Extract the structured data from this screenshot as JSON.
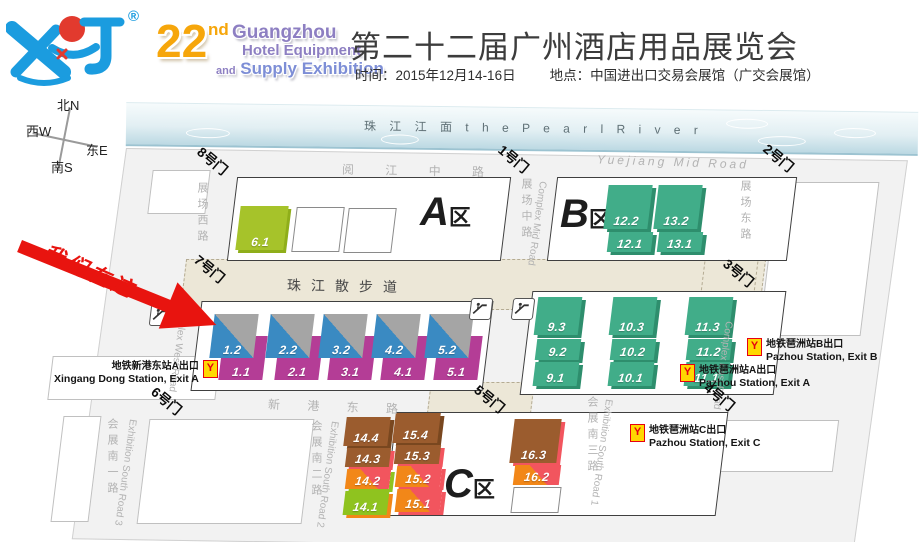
{
  "header": {
    "registered_mark": "®",
    "edition_22": "22",
    "edition_nd": "nd",
    "edition_name1": "Guangzhou",
    "edition_name2": "Hotel Equipment",
    "edition_and": "and",
    "edition_name3": "Supply Exhibition",
    "title": "第二十二届广州酒店用品展览会",
    "info_time": "时间：2015年12月14-16日",
    "info_place": "地点：中国进出口交易会展馆（广交会展馆）"
  },
  "compass": {
    "north": "北N",
    "west": "西W",
    "east": "东E",
    "south": "南S"
  },
  "map": {
    "river_label": "珠  江  江  面      t h e    P e a r l    R i v e r",
    "promenade_label": "珠江散步道",
    "roads": {
      "yuejiang_cn": "阅  江  中  路",
      "yuejiang_en": "Yuejiang  Mid  Road",
      "xingang_cn": "新  港  东  路",
      "complex_west_cn": "展场西路",
      "complex_west_en": "Complex West Road",
      "complex_mid_cn": "展场中路",
      "complex_mid_en": "Complex Mid Road",
      "complex_east_cn": "展场东路",
      "complex_east_en": "Complex East Road",
      "south1_cn": "会展南一路",
      "south1_en": "Exhibition South Road 3",
      "south2_cn": "会展南二路",
      "south2_en": "Exhibition South Road 2",
      "south3_cn": "会展南三路",
      "south3_en": "Exhibition South Road 1"
    },
    "gates": {
      "g1": "1号门",
      "g2": "2号门",
      "g3": "3号门",
      "g4": "4号门",
      "g5": "5号门",
      "g6": "6号门",
      "g7": "7号门",
      "g8": "8号门"
    },
    "zones": {
      "a": "A",
      "b": "B",
      "c": "C",
      "suffix": "区"
    },
    "halls": {
      "a_hall": "6.1",
      "b": [
        [
          "12.2",
          "12.1"
        ],
        [
          "13.2",
          "13.1"
        ]
      ],
      "strip_top": [
        "1.2",
        "2.2",
        "3.2",
        "4.2",
        "5.2"
      ],
      "strip_bottom": [
        "1.1",
        "2.1",
        "3.1",
        "4.1",
        "5.1"
      ],
      "teal": [
        [
          "9.3",
          "9.2",
          "9.1"
        ],
        [
          "10.3",
          "10.2",
          "10.1"
        ],
        [
          "11.3",
          "11.2",
          "11.1"
        ]
      ],
      "c14": [
        "14.4",
        "14.3",
        "14.2",
        "14.1"
      ],
      "c15": [
        "15.4",
        "15.3",
        "15.2",
        "15.1"
      ],
      "c16": [
        "16.3",
        "16.2"
      ]
    },
    "metro": {
      "logo_glyph": "Y",
      "xingang": {
        "cn": "地铁新港东站A出口",
        "en": "Xingang Dong Station, Exit A"
      },
      "pazhou_b": {
        "cn": "地铁琶洲站B出口",
        "en": "Pazhou Station, Exit B"
      },
      "pazhou_a": {
        "cn": "地铁琶洲站A出口",
        "en": "Pazhou Station, Exit A"
      },
      "pazhou_c": {
        "cn": "地铁琶洲站C出口",
        "en": "Pazhou Station, Exit C"
      }
    },
    "here_marker": "我们在这"
  },
  "colors": {
    "teal": "#41ad89",
    "lime": "#a6c32a",
    "blue": "#3a8ac2",
    "gray": "#a5a5a5",
    "magenta": "#b43d96",
    "brown": "#9b5c2e",
    "orange": "#f28718",
    "red": "#f2555e",
    "lime2": "#8fc31f",
    "arrow_red": "#e8140f",
    "metro_yellow": "#ffd800",
    "metro_red": "#e60012",
    "beige": "#ece7d7",
    "logo_blue": "#1b9cdf",
    "gold": "#f6a60b",
    "purple": "#8d7fc2"
  }
}
